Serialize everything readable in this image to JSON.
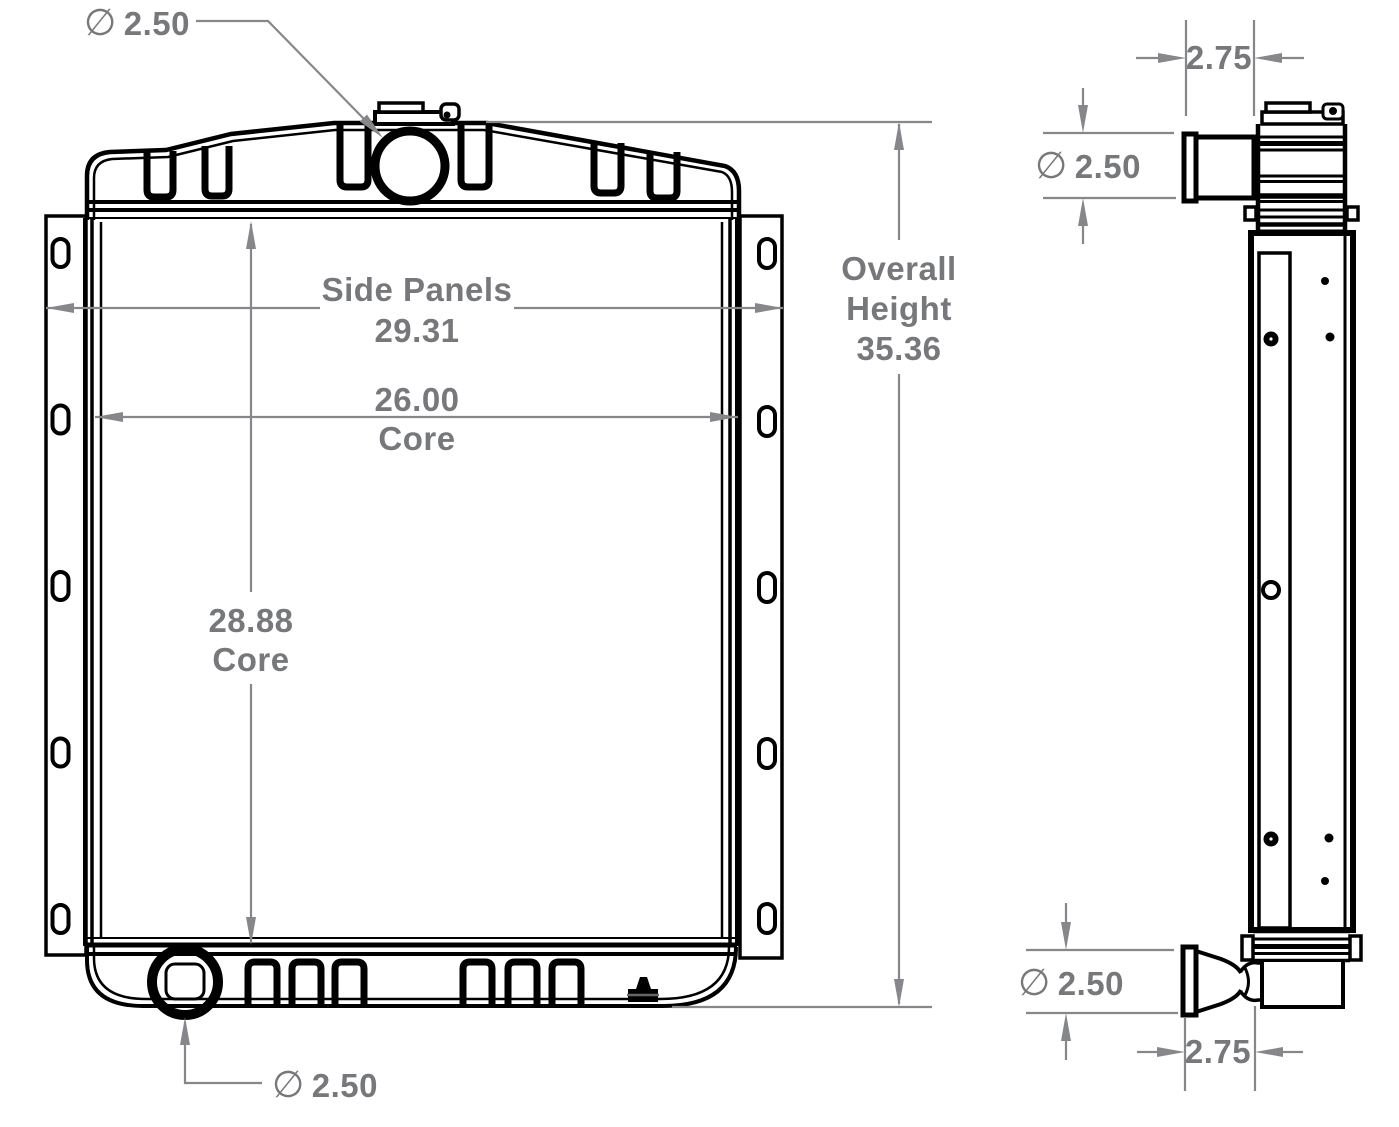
{
  "colors": {
    "line": "#000000",
    "dimension": "#77787b"
  },
  "front_view": {
    "top_port": {
      "symbol": "∅",
      "value": "2.50"
    },
    "side_panels": {
      "label": "Side Panels",
      "value": "29.31"
    },
    "core_width": {
      "value": "26.00",
      "label": "Core"
    },
    "core_height": {
      "value": "28.88",
      "label": "Core"
    },
    "overall_height": {
      "label_line1": "Overall",
      "label_line2": "Height",
      "value": "35.36"
    },
    "bottom_port": {
      "symbol": "∅",
      "value": "2.50"
    }
  },
  "side_view": {
    "top_depth": {
      "value": "2.75"
    },
    "top_port": {
      "symbol": "∅",
      "value": "2.50"
    },
    "bottom_port": {
      "symbol": "∅",
      "value": "2.50"
    },
    "bottom_depth": {
      "value": "2.75"
    }
  }
}
